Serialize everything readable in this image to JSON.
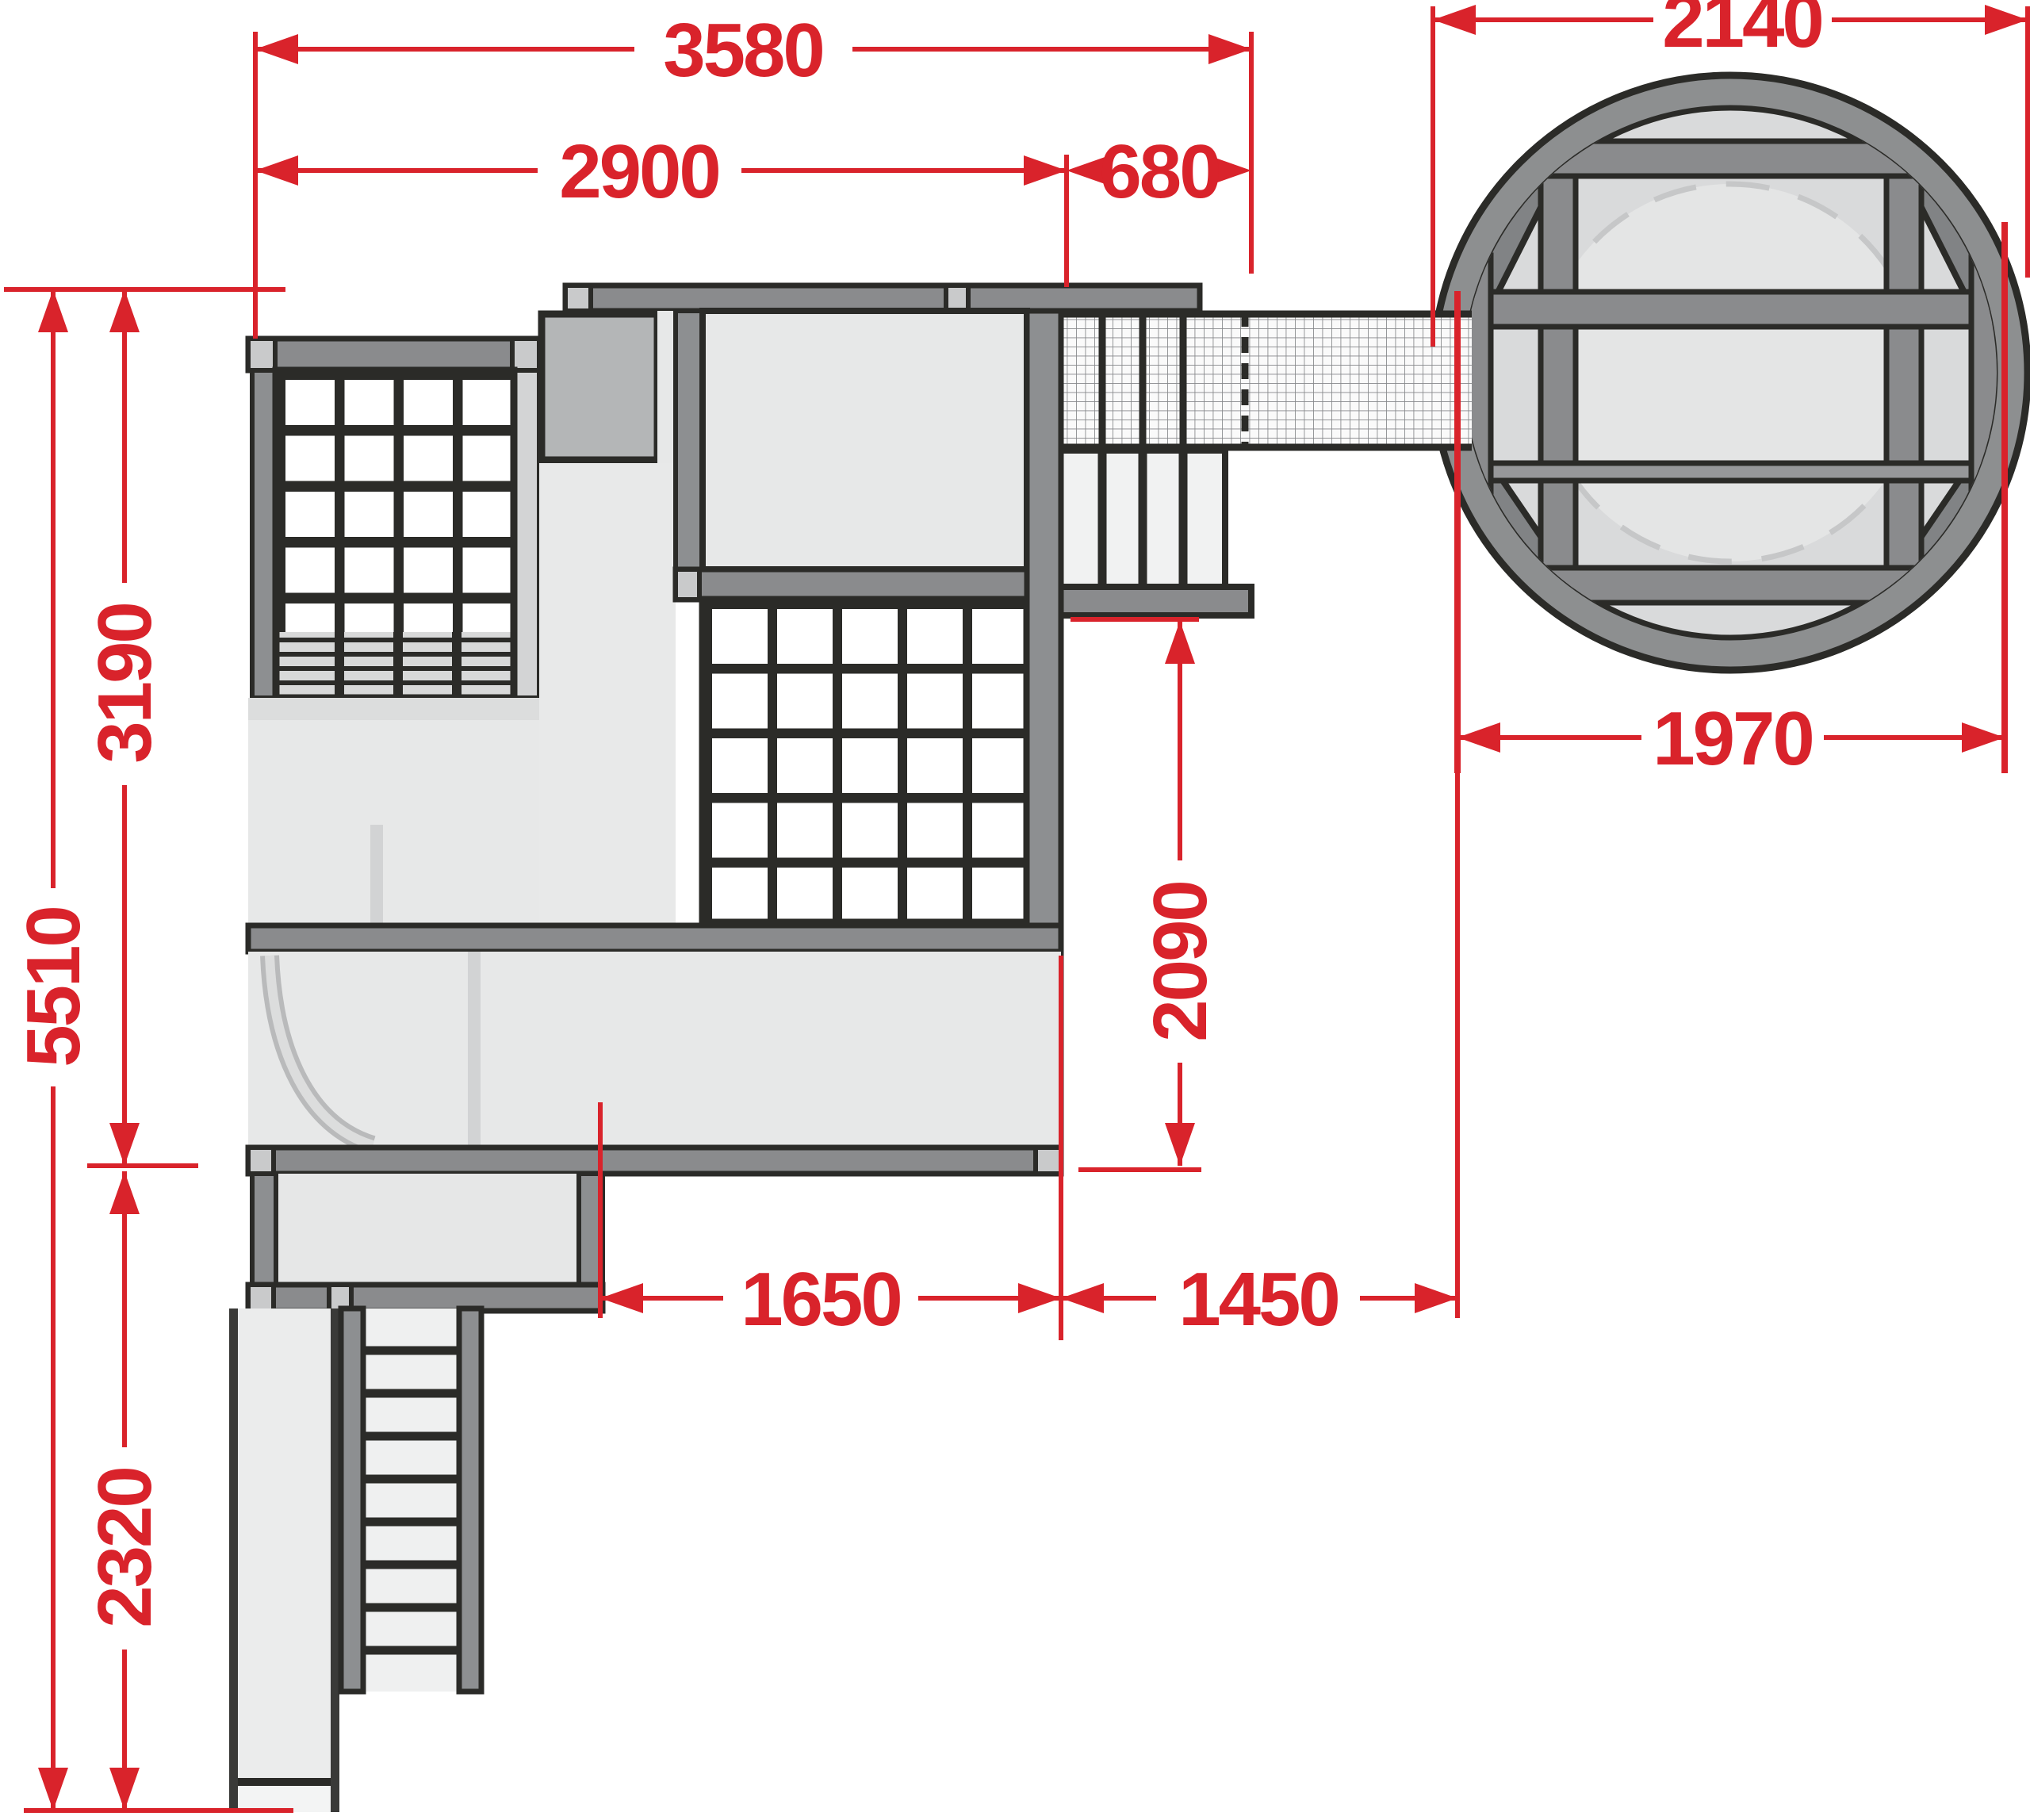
{
  "diagram": {
    "kind": "playground-structure-dimension-plan",
    "colors": {
      "dimension_red": "#d9232b",
      "outline_black": "#2b2b28",
      "bar_dark_gray": "#8a8b8d",
      "post_gray": "#8d8f91",
      "square_mid_gray": "#b4b6b7",
      "corner_light_gray": "#c9cacb",
      "platform_pale": "#e7e8e8",
      "slat_gray": "#d8d9d9",
      "circle_rim_gray": "#8d8f90",
      "circle_inner_gray": "#d9dadb"
    },
    "dimensions": {
      "total_width": "3580",
      "tower_width": "2900",
      "bay_width": "680",
      "circle_outer": "2140",
      "circle_platform": "1970",
      "upper_height": "3190",
      "total_height": "5510",
      "lower_height": "2320",
      "bottom_left_span": "1650",
      "bottom_right_span": "1450",
      "bay_drop": "2090"
    }
  }
}
